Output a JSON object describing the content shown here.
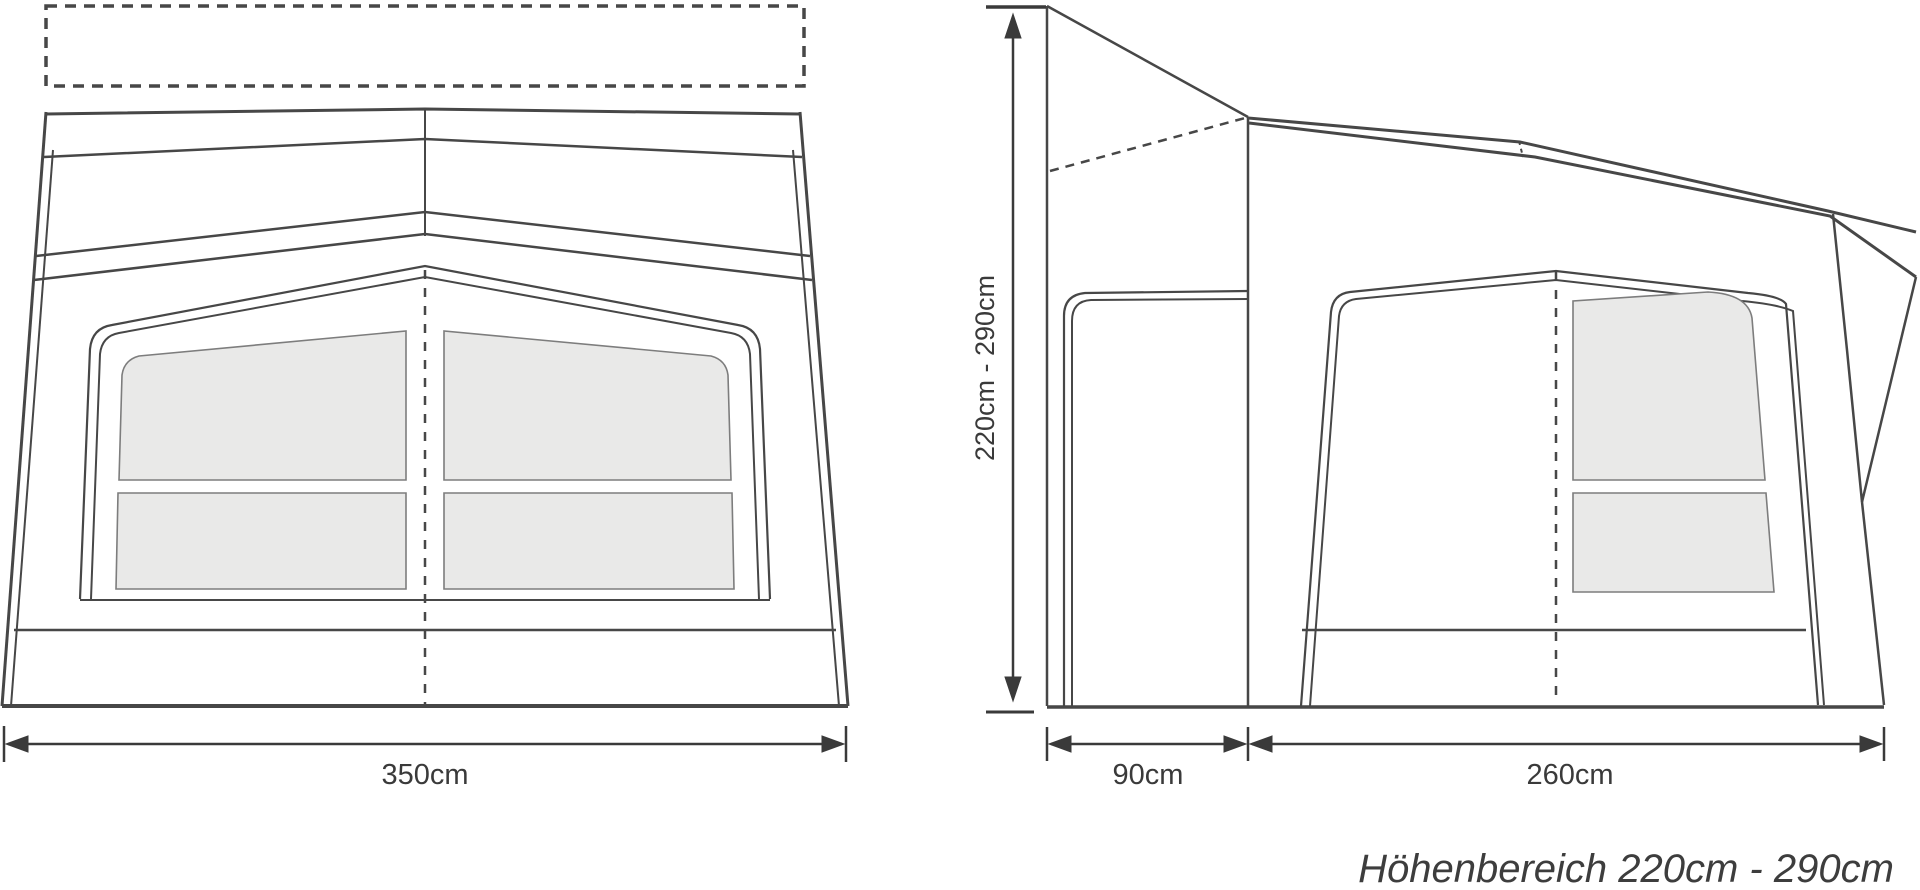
{
  "figure": {
    "type": "awning-dimension-diagram",
    "caption": "Höhenbereich 220cm - 290cm",
    "front_view": {
      "name": "front elevation of caravan awning",
      "width_label": "350cm"
    },
    "side_view": {
      "name": "side elevation of caravan awning",
      "height_label": "220cm - 290cm",
      "depth_label": "90cm",
      "length_label": "260cm"
    },
    "colors": {
      "line": "#474747",
      "window_fill": "#e9e9e8",
      "window_border": "#7d7d7d",
      "text": "#3a3a3a",
      "background": "#ffffff"
    }
  }
}
